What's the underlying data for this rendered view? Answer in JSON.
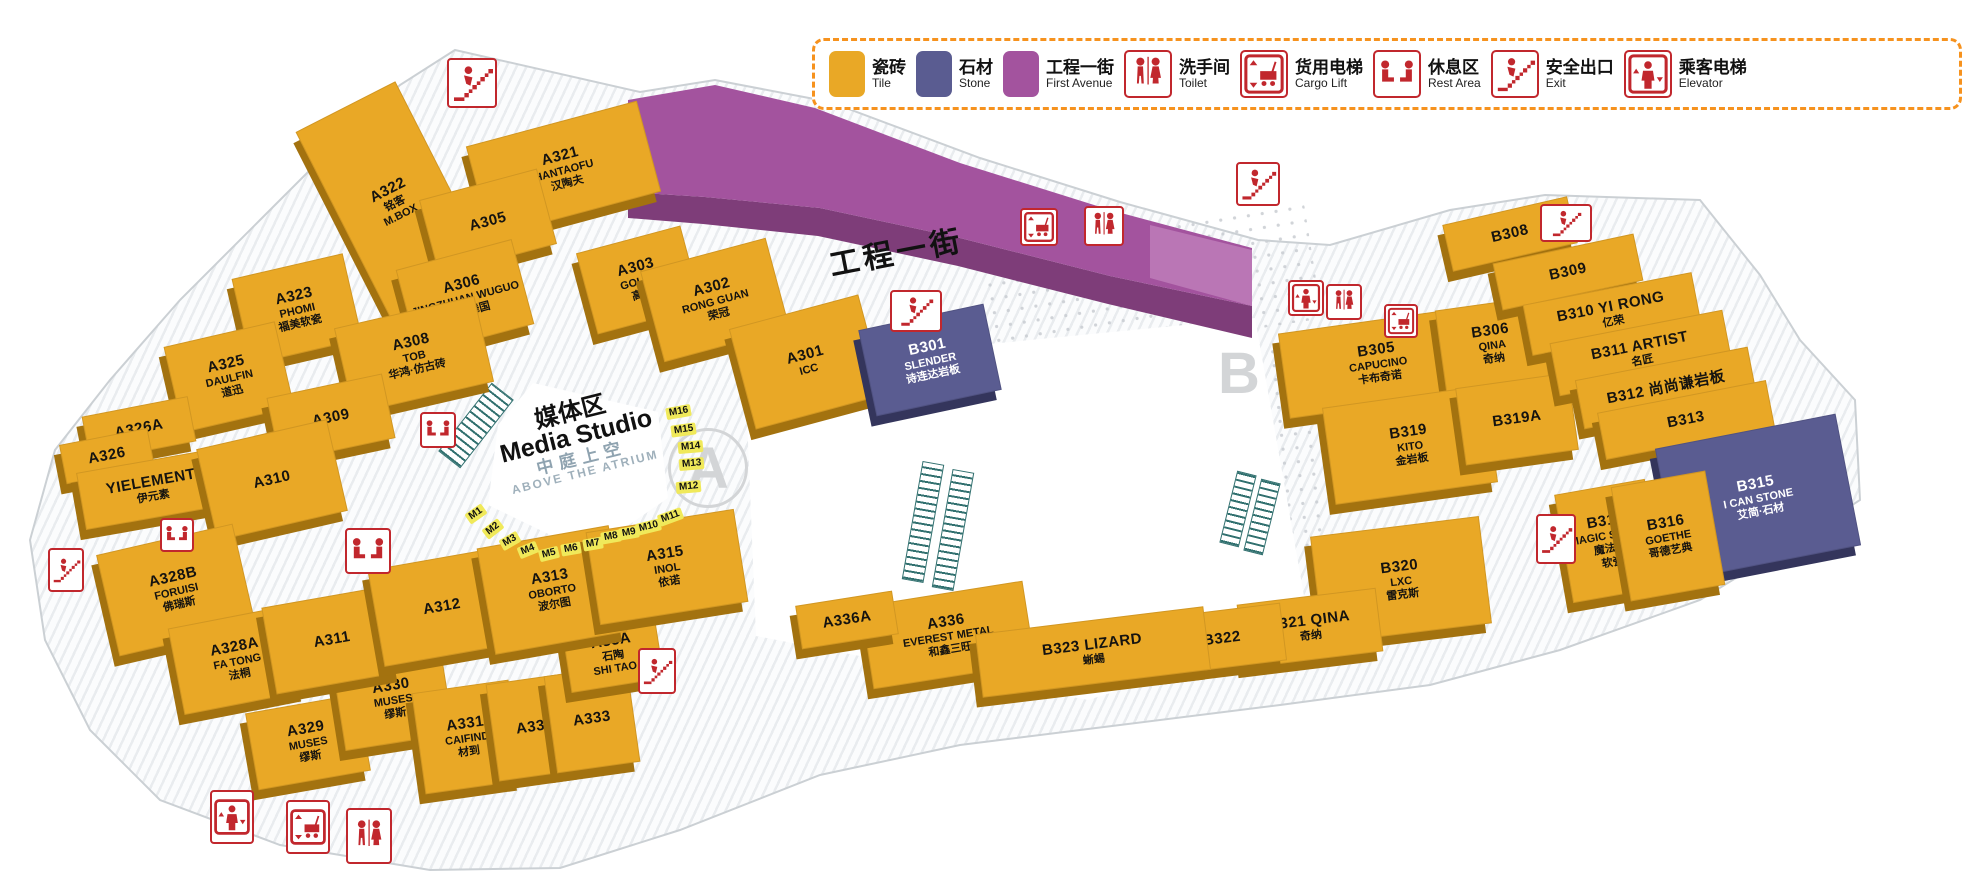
{
  "colors": {
    "tile": "#E9A826",
    "stone": "#5A5C91",
    "avenue": "#A3539E",
    "avenue_front": "#7E3D79",
    "avenue_end": "#BC7AB7",
    "icon_red": "#C1272D",
    "legend_border": "#F6921E",
    "slot_yellow": "#F0E95A"
  },
  "legend": {
    "items": [
      {
        "kind": "swatch",
        "swatch": "tile",
        "cn": "瓷砖",
        "en": "Tile"
      },
      {
        "kind": "swatch",
        "swatch": "stone",
        "cn": "石材",
        "en": "Stone"
      },
      {
        "kind": "swatch",
        "swatch": "avenue",
        "cn": "工程一街",
        "en": "First Avenue"
      },
      {
        "kind": "icon",
        "icon": "toilet",
        "cn": "洗手间",
        "en": "Toilet"
      },
      {
        "kind": "icon",
        "icon": "cargo-lift",
        "cn": "货用电梯",
        "en": "Cargo Lift"
      },
      {
        "kind": "icon",
        "icon": "rest-area",
        "cn": "休息区",
        "en": "Rest Area"
      },
      {
        "kind": "icon",
        "icon": "exit",
        "cn": "安全出口",
        "en": "Exit"
      },
      {
        "kind": "icon",
        "icon": "elevator",
        "cn": "乘客电梯",
        "en": "Elevator"
      }
    ]
  },
  "street": {
    "name": "工程一街"
  },
  "media_studio": {
    "cn": "媒体区",
    "en": "Media Studio",
    "sub_cn": "中庭上空",
    "sub_en": "ABOVE THE ATRIUM"
  },
  "zones": {
    "a": "A",
    "b": "B"
  },
  "booths": [
    {
      "id": "A322",
      "x": 338,
      "y": 95,
      "w": 110,
      "h": 212,
      "rot": -27,
      "lines": [
        "A322",
        "铭客",
        "M.BOX"
      ]
    },
    {
      "id": "A321",
      "x": 475,
      "y": 122,
      "w": 175,
      "h": 92,
      "rot": -15,
      "lines": [
        "A321",
        "HANTAOFU",
        "汉陶夫"
      ]
    },
    {
      "id": "A305",
      "x": 427,
      "y": 183,
      "w": 120,
      "h": 76,
      "rot": -15,
      "lines": [
        "A305"
      ]
    },
    {
      "id": "A306",
      "x": 405,
      "y": 253,
      "w": 118,
      "h": 86,
      "rot": -15,
      "lines": [
        "A306",
        "JINGZHUAN WUGUO",
        "晶砖舞国"
      ]
    },
    {
      "id": "A303",
      "x": 585,
      "y": 238,
      "w": 106,
      "h": 82,
      "rot": -15,
      "lines": [
        "A303",
        "GOLDE",
        "高德"
      ]
    },
    {
      "id": "A302",
      "x": 650,
      "y": 253,
      "w": 128,
      "h": 92,
      "rot": -15,
      "lines": [
        "A302",
        "RONG GUAN",
        "荣冠"
      ]
    },
    {
      "id": "A301",
      "x": 740,
      "y": 310,
      "w": 132,
      "h": 102,
      "rot": -15,
      "lines": [
        "A301",
        "ICC"
      ]
    },
    {
      "id": "A323",
      "x": 240,
      "y": 265,
      "w": 112,
      "h": 86,
      "rot": -13,
      "lines": [
        "A323",
        "PHOMI",
        "福美软瓷"
      ]
    },
    {
      "id": "A325",
      "x": 172,
      "y": 333,
      "w": 112,
      "h": 86,
      "rot": -13,
      "lines": [
        "A325",
        "DAULFIN",
        "道迅"
      ]
    },
    {
      "id": "A308",
      "x": 342,
      "y": 311,
      "w": 142,
      "h": 86,
      "rot": -13,
      "lines": [
        "A308",
        "TOB",
        "华鸿·仿古砖"
      ]
    },
    {
      "id": "A309",
      "x": 272,
      "y": 385,
      "w": 116,
      "h": 64,
      "rot": -12,
      "lines": [
        "A309"
      ]
    },
    {
      "id": "A326A",
      "x": 85,
      "y": 406,
      "w": 106,
      "h": 44,
      "rot": -11,
      "lines": [
        "A326A"
      ]
    },
    {
      "id": "A326",
      "x": 62,
      "y": 436,
      "w": 88,
      "h": 38,
      "rot": -11,
      "lines": [
        "A326"
      ]
    },
    {
      "id": "YIELEMENT",
      "x": 80,
      "y": 460,
      "w": 142,
      "h": 56,
      "rot": -10,
      "lines": [
        "YIELEMENT",
        "伊元素"
      ]
    },
    {
      "id": "A310",
      "x": 205,
      "y": 433,
      "w": 132,
      "h": 92,
      "rot": -13,
      "lines": [
        "A310"
      ]
    },
    {
      "id": "A328B",
      "x": 106,
      "y": 538,
      "w": 138,
      "h": 102,
      "rot": -13,
      "lines": [
        "A328B",
        "FORUISI",
        "佛瑞斯"
      ]
    },
    {
      "id": "A328A",
      "x": 175,
      "y": 616,
      "w": 122,
      "h": 86,
      "rot": -11,
      "lines": [
        "A328A",
        "FA TONG",
        "法桐"
      ]
    },
    {
      "id": "A329",
      "x": 251,
      "y": 703,
      "w": 112,
      "h": 76,
      "rot": -10,
      "lines": [
        "A329",
        "MUSES",
        "缪斯"
      ]
    },
    {
      "id": "A330",
      "x": 338,
      "y": 655,
      "w": 108,
      "h": 86,
      "rot": -9,
      "lines": [
        "A330",
        "MUSES",
        "缪斯"
      ]
    },
    {
      "id": "A331",
      "x": 418,
      "y": 686,
      "w": 96,
      "h": 100,
      "rot": -8,
      "lines": [
        "A331",
        "CAIFIND",
        "材到"
      ]
    },
    {
      "id": "A332",
      "x": 492,
      "y": 678,
      "w": 84,
      "h": 96,
      "rot": -8,
      "lines": [
        "A332"
      ]
    },
    {
      "id": "A333",
      "x": 550,
      "y": 670,
      "w": 82,
      "h": 96,
      "rot": -8,
      "lines": [
        "A333"
      ]
    },
    {
      "id": "A33A",
      "x": 566,
      "y": 622,
      "w": 92,
      "h": 62,
      "rot": -9,
      "lines": [
        "A33A",
        "石陶",
        "SHI TAO"
      ]
    },
    {
      "id": "A311",
      "x": 268,
      "y": 596,
      "w": 126,
      "h": 86,
      "rot": -10,
      "lines": [
        "A311"
      ]
    },
    {
      "id": "A312",
      "x": 375,
      "y": 558,
      "w": 132,
      "h": 96,
      "rot": -10,
      "lines": [
        "A312"
      ]
    },
    {
      "id": "A313",
      "x": 485,
      "y": 536,
      "w": 132,
      "h": 106,
      "rot": -10,
      "lines": [
        "A313",
        "OBORTO",
        "波尔图"
      ]
    },
    {
      "id": "A315",
      "x": 592,
      "y": 520,
      "w": 148,
      "h": 92,
      "rot": -9,
      "lines": [
        "A315",
        "INOL",
        "依诺"
      ]
    },
    {
      "id": "A336",
      "x": 866,
      "y": 593,
      "w": 162,
      "h": 82,
      "rot": -9,
      "lines": [
        "A336",
        "EVEREST METAL",
        "和鑫三旺"
      ]
    },
    {
      "id": "A336A",
      "x": 798,
      "y": 598,
      "w": 96,
      "h": 42,
      "rot": -9,
      "lines": [
        "A336A"
      ]
    },
    {
      "id": "B301",
      "x": 866,
      "y": 316,
      "w": 126,
      "h": 86,
      "rot": -12,
      "type": "stone",
      "lines": [
        "B301",
        "SLENDER",
        "诗连达岩板"
      ]
    },
    {
      "id": "B305",
      "x": 1283,
      "y": 320,
      "w": 188,
      "h": 84,
      "rot": -8,
      "lines": [
        "B305",
        "CAPUCINO",
        "卡布奇诺"
      ]
    },
    {
      "id": "B306",
      "x": 1440,
      "y": 303,
      "w": 102,
      "h": 80,
      "rot": -8,
      "lines": [
        "B306",
        "QINA",
        "奇纳"
      ]
    },
    {
      "id": "B319",
      "x": 1328,
      "y": 396,
      "w": 162,
      "h": 96,
      "rot": -8,
      "lines": [
        "B319",
        "KITO",
        "金岩板"
      ]
    },
    {
      "id": "B319A",
      "x": 1460,
      "y": 380,
      "w": 112,
      "h": 76,
      "rot": -8,
      "lines": [
        "B319A"
      ]
    },
    {
      "id": "B308",
      "x": 1446,
      "y": 210,
      "w": 126,
      "h": 46,
      "rot": -13,
      "lines": [
        "B308"
      ]
    },
    {
      "id": "B309",
      "x": 1496,
      "y": 248,
      "w": 142,
      "h": 46,
      "rot": -12,
      "lines": [
        "B309"
      ]
    },
    {
      "id": "B310",
      "x": 1526,
      "y": 288,
      "w": 170,
      "h": 50,
      "rot": -11,
      "lines": [
        "B310 YI RONG",
        "亿荣"
      ]
    },
    {
      "id": "B311",
      "x": 1553,
      "y": 326,
      "w": 174,
      "h": 52,
      "rot": -11,
      "lines": [
        "B311  ARTIST",
        "名匠"
      ]
    },
    {
      "id": "B312",
      "x": 1578,
      "y": 363,
      "w": 174,
      "h": 48,
      "rot": -11,
      "lines": [
        "B312  尚尚谦岩板"
      ]
    },
    {
      "id": "B313",
      "x": 1600,
      "y": 396,
      "w": 170,
      "h": 46,
      "rot": -11,
      "lines": [
        "B313"
      ]
    },
    {
      "id": "B315",
      "x": 1666,
      "y": 430,
      "w": 182,
      "h": 132,
      "rot": -11,
      "type": "stone",
      "lines": [
        "B315",
        "I CAN STONE",
        "艾简·石材"
      ]
    },
    {
      "id": "B318",
      "x": 1563,
      "y": 486,
      "w": 90,
      "h": 108,
      "rot": -10,
      "lines": [
        "B318",
        "MAGIC STONE",
        "魔法石",
        "软瓷"
      ]
    },
    {
      "id": "B316",
      "x": 1620,
      "y": 478,
      "w": 94,
      "h": 114,
      "rot": -10,
      "lines": [
        "B316",
        "GOETHE",
        "哥德艺典"
      ]
    },
    {
      "id": "B320",
      "x": 1316,
      "y": 526,
      "w": 168,
      "h": 106,
      "rot": -7,
      "lines": [
        "B320",
        "LXC",
        "雷克斯"
      ]
    },
    {
      "id": "B321",
      "x": 1240,
      "y": 596,
      "w": 138,
      "h": 62,
      "rot": -7,
      "lines": [
        "B321 QINA",
        "奇纳"
      ]
    },
    {
      "id": "B322",
      "x": 1160,
      "y": 610,
      "w": 122,
      "h": 56,
      "rot": -7,
      "lines": [
        "B322"
      ]
    },
    {
      "id": "B323",
      "x": 978,
      "y": 620,
      "w": 228,
      "h": 62,
      "rot": -7,
      "lines": [
        "B323  LIZARD",
        "蜥蜴"
      ]
    }
  ],
  "media_slots": [
    {
      "label": "M1",
      "x": 466,
      "y": 508,
      "rot": -35
    },
    {
      "label": "M2",
      "x": 483,
      "y": 523,
      "rot": -38
    },
    {
      "label": "M3",
      "x": 500,
      "y": 535,
      "rot": -30
    },
    {
      "label": "M4",
      "x": 518,
      "y": 544,
      "rot": -22
    },
    {
      "label": "M5",
      "x": 539,
      "y": 548,
      "rot": -14
    },
    {
      "label": "M6",
      "x": 561,
      "y": 543,
      "rot": -10
    },
    {
      "label": "M7",
      "x": 583,
      "y": 538,
      "rot": -10
    },
    {
      "label": "M8",
      "x": 601,
      "y": 531,
      "rot": -10
    },
    {
      "label": "M9",
      "x": 619,
      "y": 527,
      "rot": -10
    },
    {
      "label": "M10",
      "x": 636,
      "y": 521,
      "rot": -14
    },
    {
      "label": "M11",
      "x": 658,
      "y": 511,
      "rot": -20
    },
    {
      "label": "M12",
      "x": 676,
      "y": 481,
      "rot": -5
    },
    {
      "label": "M13",
      "x": 679,
      "y": 458,
      "rot": -5
    },
    {
      "label": "M14",
      "x": 678,
      "y": 441,
      "rot": -5
    },
    {
      "label": "M15",
      "x": 671,
      "y": 424,
      "rot": -8
    },
    {
      "label": "M16",
      "x": 666,
      "y": 406,
      "rot": -10
    }
  ],
  "map_icons": [
    {
      "type": "exit",
      "x": 447,
      "y": 58,
      "w": 44,
      "h": 44
    },
    {
      "type": "rest-area",
      "x": 420,
      "y": 412,
      "w": 30,
      "h": 30
    },
    {
      "type": "rest-area",
      "x": 160,
      "y": 518,
      "w": 28,
      "h": 28
    },
    {
      "type": "rest-area",
      "x": 345,
      "y": 528,
      "w": 40,
      "h": 40
    },
    {
      "type": "exit",
      "x": 890,
      "y": 290,
      "w": 46,
      "h": 36
    },
    {
      "type": "cargo-lift",
      "x": 1020,
      "y": 208,
      "w": 32,
      "h": 32
    },
    {
      "type": "toilet",
      "x": 1084,
      "y": 206,
      "w": 34,
      "h": 34
    },
    {
      "type": "exit",
      "x": 1236,
      "y": 162,
      "w": 38,
      "h": 38
    },
    {
      "type": "elevator",
      "x": 1288,
      "y": 280,
      "w": 30,
      "h": 30
    },
    {
      "type": "toilet",
      "x": 1326,
      "y": 284,
      "w": 30,
      "h": 30
    },
    {
      "type": "cargo-lift",
      "x": 1384,
      "y": 304,
      "w": 28,
      "h": 28
    },
    {
      "type": "exit",
      "x": 1540,
      "y": 204,
      "w": 46,
      "h": 32
    },
    {
      "type": "exit",
      "x": 1536,
      "y": 514,
      "w": 34,
      "h": 44
    },
    {
      "type": "exit",
      "x": 638,
      "y": 648,
      "w": 32,
      "h": 40
    },
    {
      "type": "exit",
      "x": 48,
      "y": 548,
      "w": 30,
      "h": 38
    },
    {
      "type": "elevator",
      "x": 210,
      "y": 790,
      "w": 38,
      "h": 48
    },
    {
      "type": "cargo-lift",
      "x": 286,
      "y": 800,
      "w": 38,
      "h": 48
    },
    {
      "type": "toilet",
      "x": 346,
      "y": 808,
      "w": 40,
      "h": 50
    }
  ]
}
